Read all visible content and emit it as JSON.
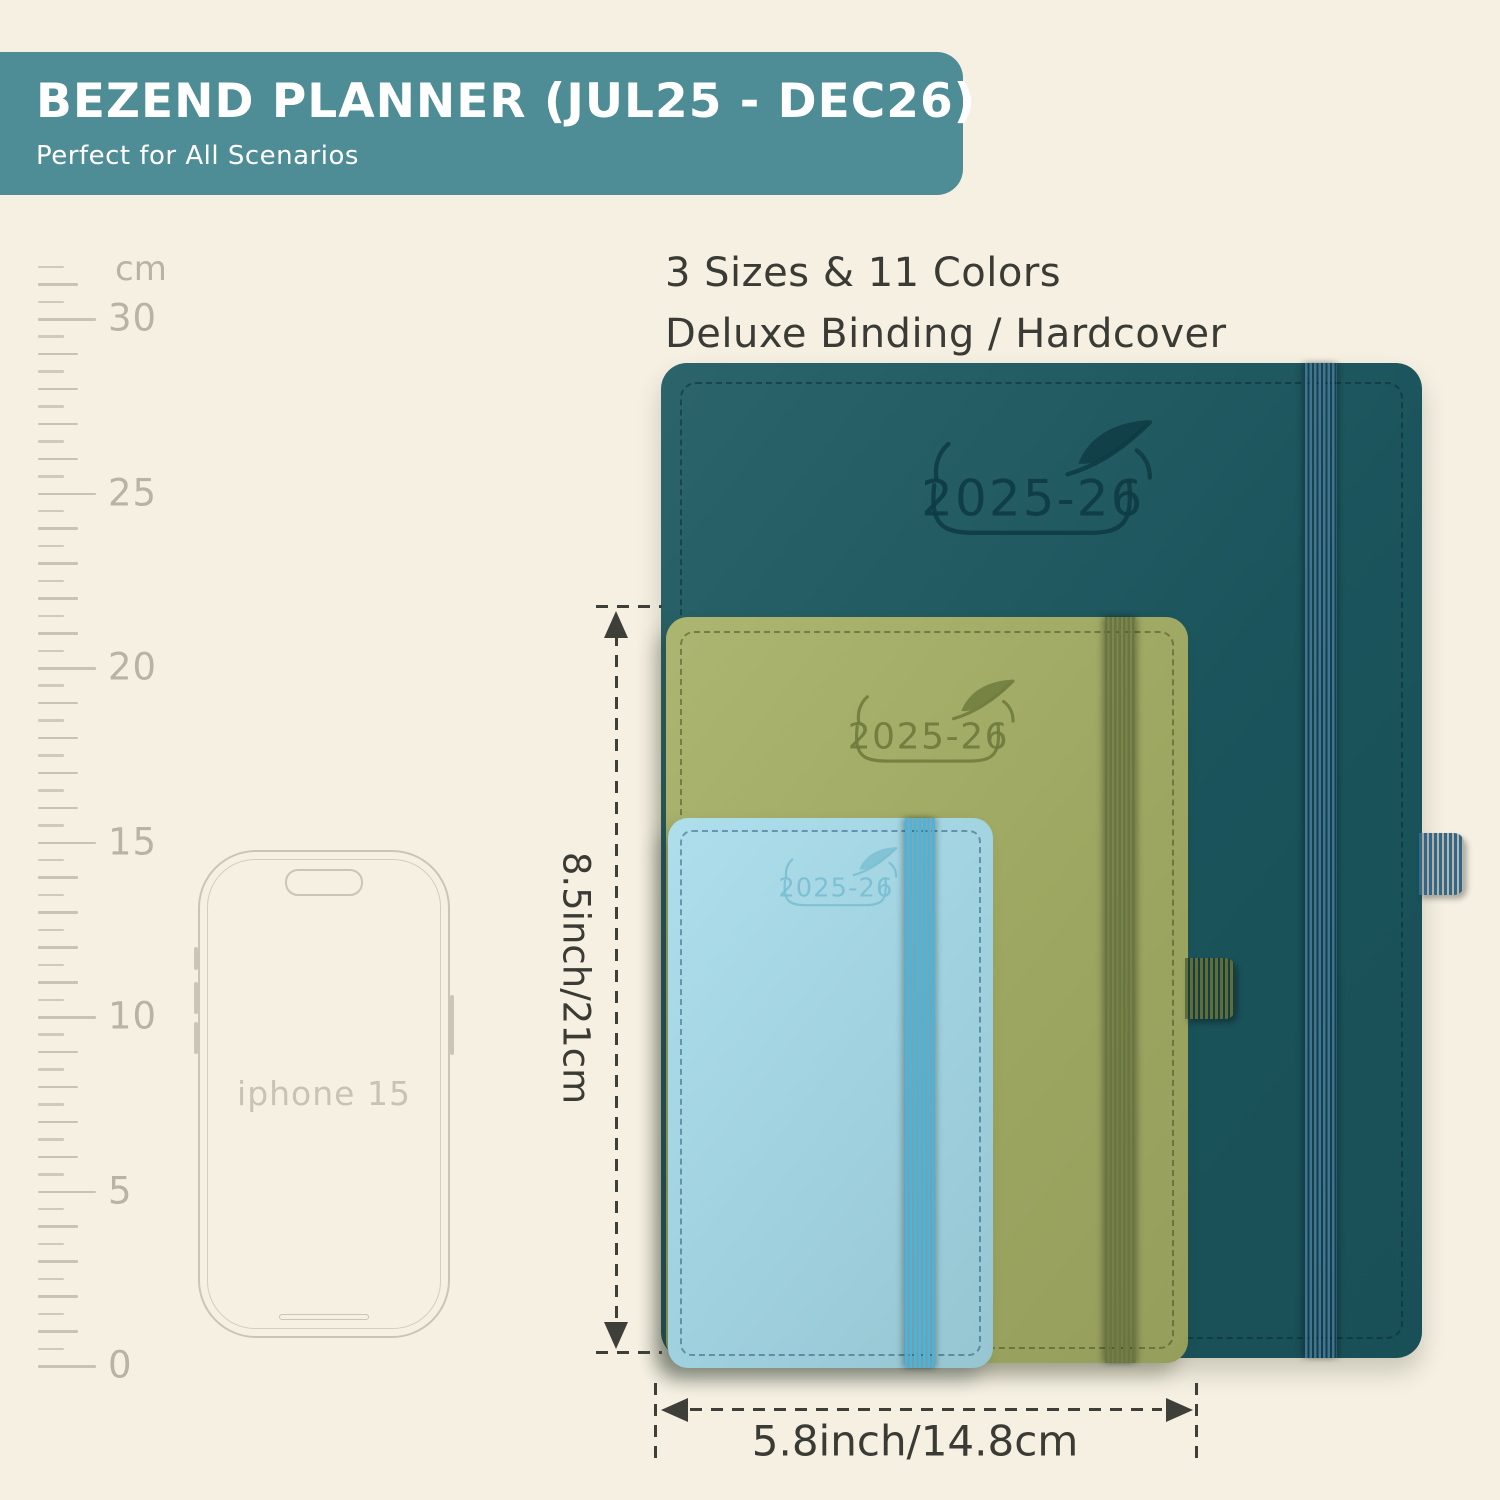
{
  "banner": {
    "title": "BEZEND PLANNER (JUL25 - DEC26)",
    "subtitle": "Perfect for All Scenarios",
    "bg": "#4e8d96"
  },
  "headline": {
    "line1": "3 Sizes & 11 Colors",
    "line2": "Deluxe Binding / Hardcover"
  },
  "ruler": {
    "unit": "cm",
    "labels": [
      "0",
      "5",
      "10",
      "15",
      "20",
      "25",
      "30"
    ]
  },
  "phone": {
    "label": "iphone 15"
  },
  "planners": [
    {
      "size": "large",
      "year": "2025-26",
      "cover": "#1c5860",
      "logo": "#0e3c44",
      "elastic": "#3f7495",
      "pen_loop": "#31688a",
      "stitch": "rgba(10,40,45,0.50)"
    },
    {
      "size": "medium",
      "year": "2025-26",
      "cover": "#a6b066",
      "logo": "#6f7c3d",
      "elastic": "#68763f",
      "pen_loop": "#5f6e39",
      "stitch": "rgba(70,82,35,0.55)"
    },
    {
      "size": "small",
      "year": "2025-26",
      "cover": "#a8dcea",
      "logo": "#7bbfd2",
      "elastic": "#47b6de",
      "stitch": "rgba(16,70,105,0.45)"
    }
  ],
  "dimensions": {
    "height": "8.5inch/21cm",
    "width": "5.8inch/14.8cm"
  }
}
